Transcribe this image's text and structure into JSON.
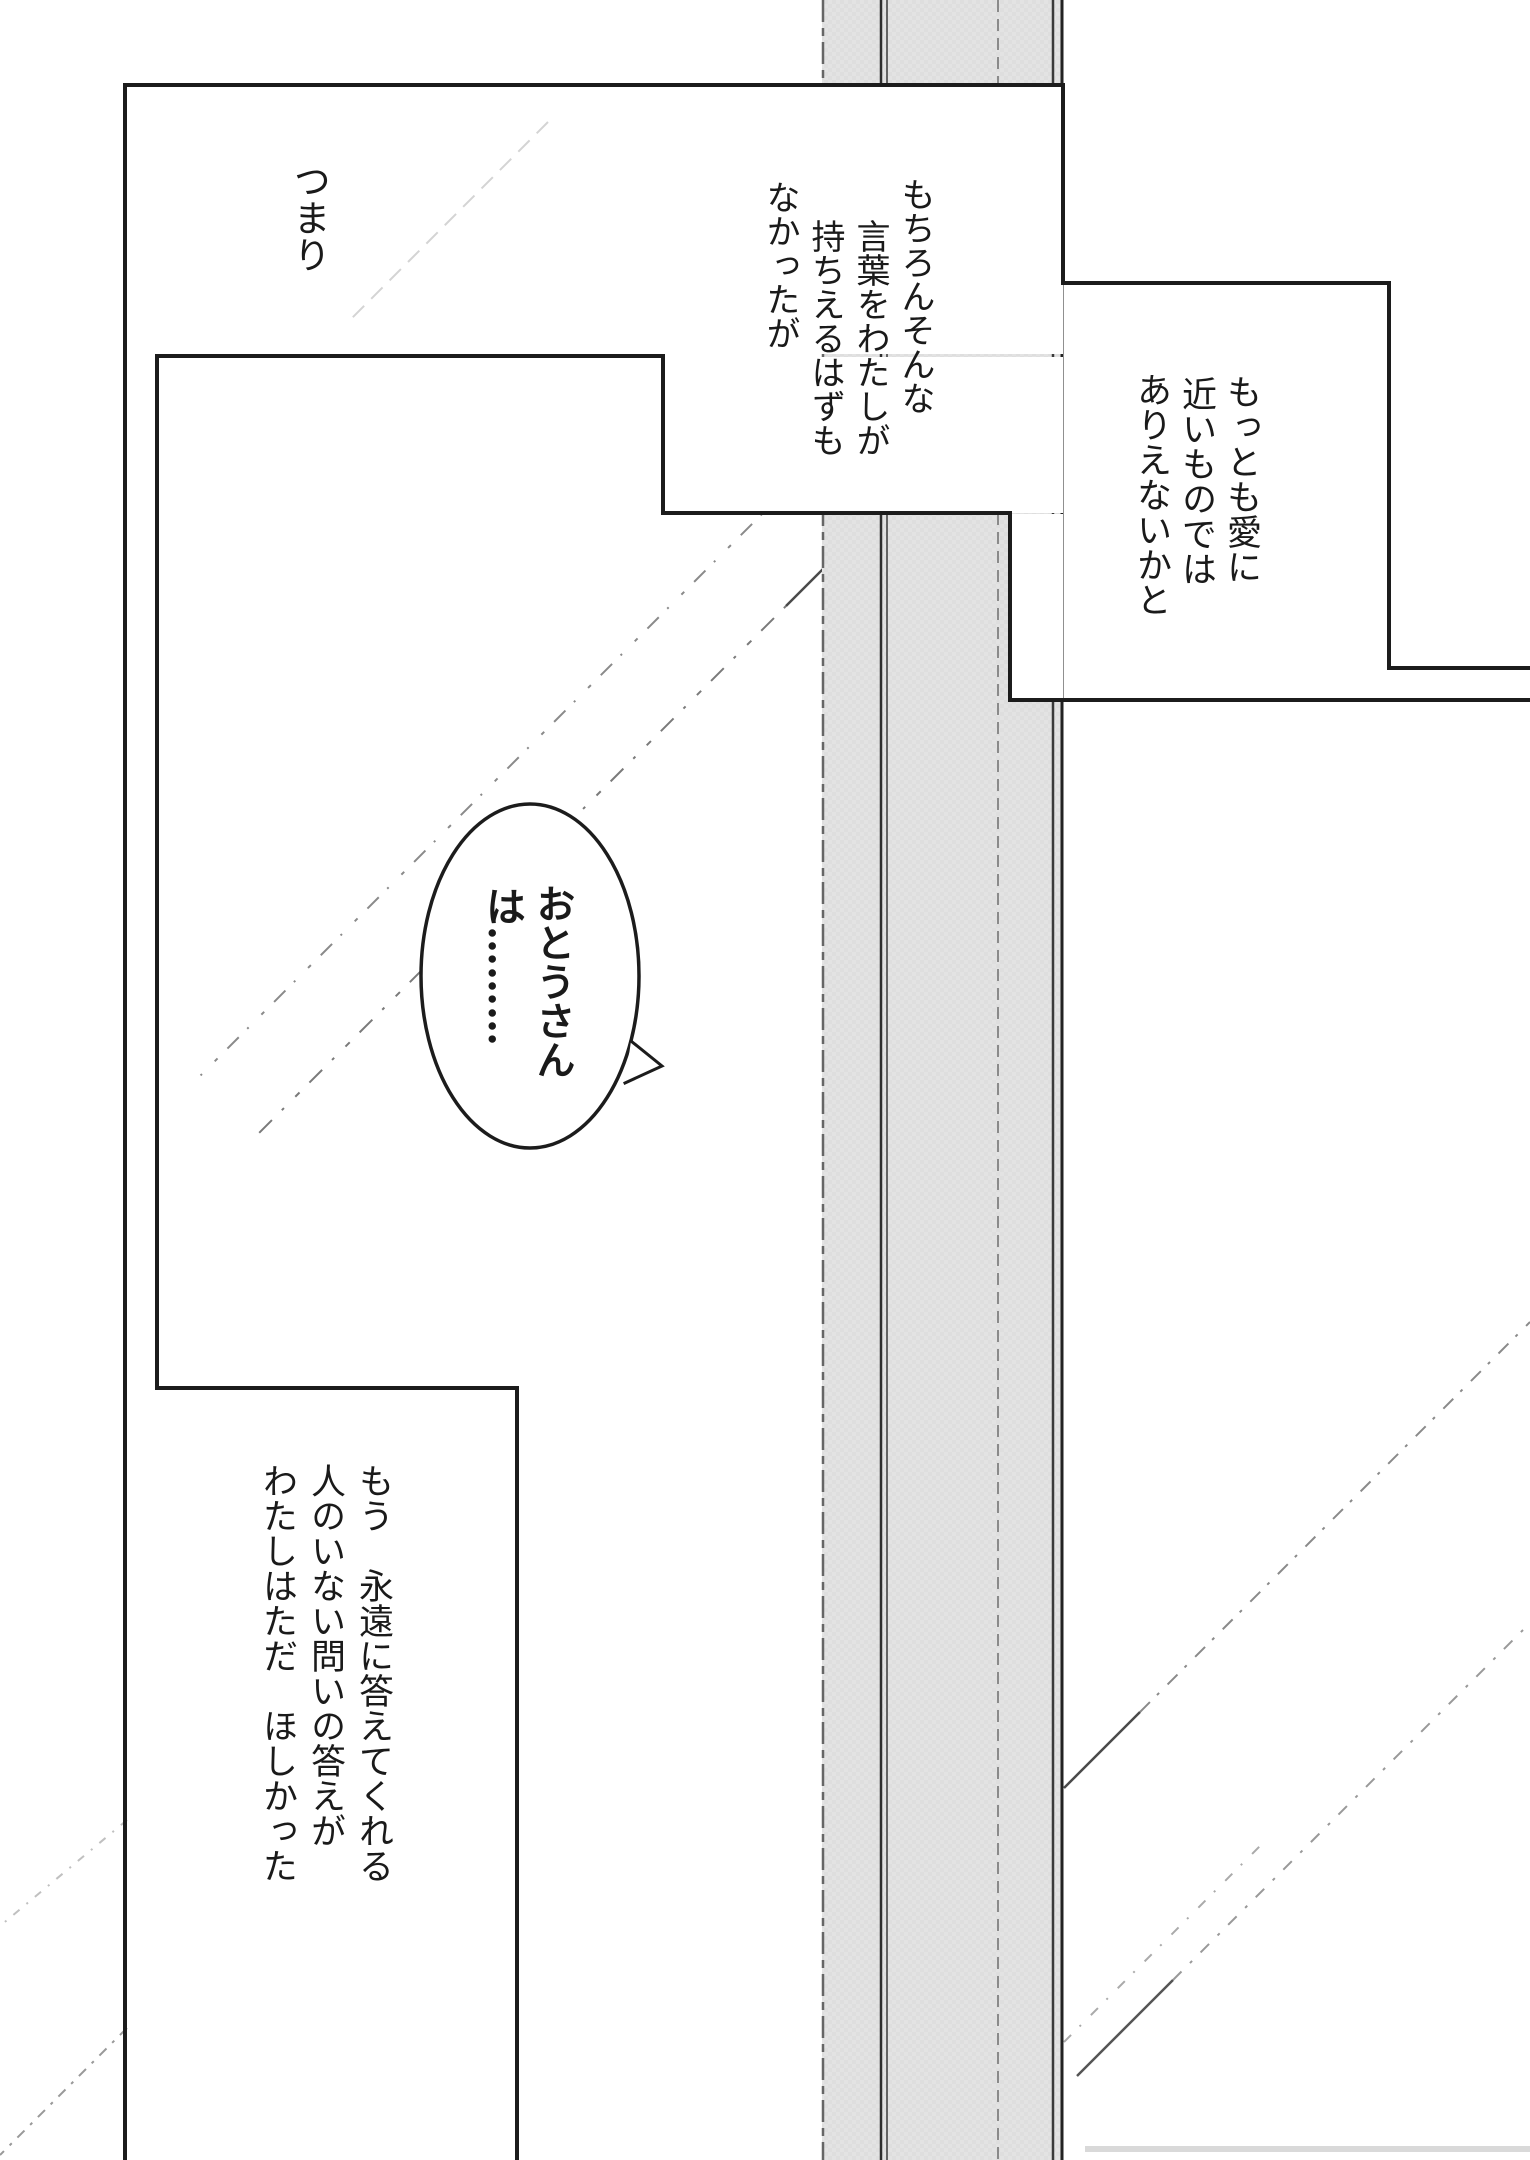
{
  "document": {
    "type": "manga-page",
    "language": "ja"
  },
  "narration": {
    "tsumari": {
      "col0": "つまり"
    },
    "mochiron": {
      "col0": "もちろんそんな",
      "col1": "言葉をわたしが",
      "col2": "持ちえるはずも",
      "col3": "なかったが"
    },
    "ai": {
      "col0": "もっとも愛に",
      "col1": "近いものでは",
      "col2": "ありえないかと"
    },
    "mou": {
      "col0": "もう　永遠に答えてくれる",
      "col1": "人のいない問いの答えが",
      "col2": "わたしはただ　ほしかった"
    }
  },
  "bubble": {
    "name": "おとうさん",
    "particle": "は",
    "ellipsis": "………"
  },
  "colors": {
    "ink": "#1c1c1c",
    "paper": "#ffffff",
    "pillar_gray": "#e3e3e3"
  }
}
